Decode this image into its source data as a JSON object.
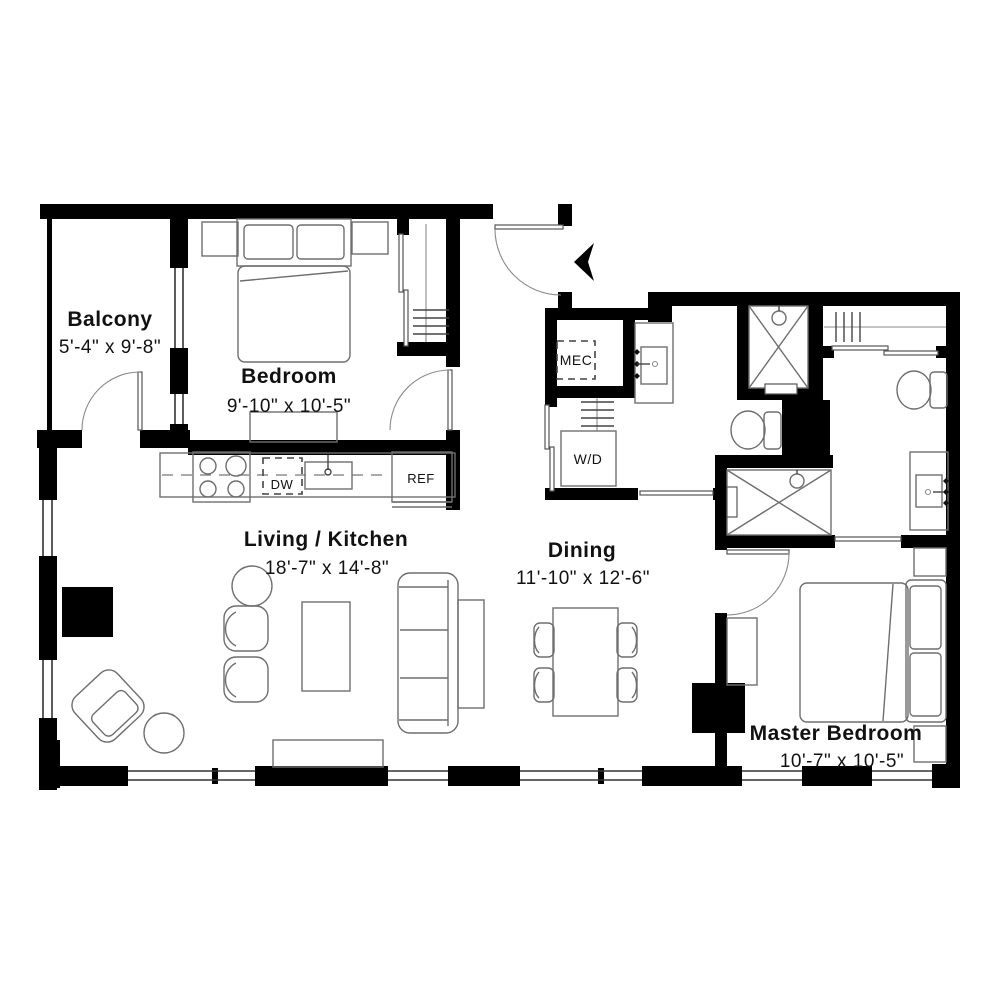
{
  "rooms": [
    {
      "name": "Balcony",
      "dims": "5'-4\" x 9'-8\""
    },
    {
      "name": "Bedroom",
      "dims": "9'-10\" x 10'-5\""
    },
    {
      "name": "Living / Kitchen",
      "dims": "18'-7\" x 14'-8\""
    },
    {
      "name": "Dining",
      "dims": "11'-10\" x 12'-6\""
    },
    {
      "name": "Master Bedroom",
      "dims": "10'-7\" x 10'-5\""
    }
  ],
  "fixtures": {
    "mec": "MEC",
    "washer_dryer": "W/D",
    "dishwasher": "DW",
    "refrigerator": "REF"
  },
  "colors": {
    "wall": "#000000",
    "furniture_line": "#6e6e6e",
    "text": "#111111",
    "background": "#ffffff"
  }
}
